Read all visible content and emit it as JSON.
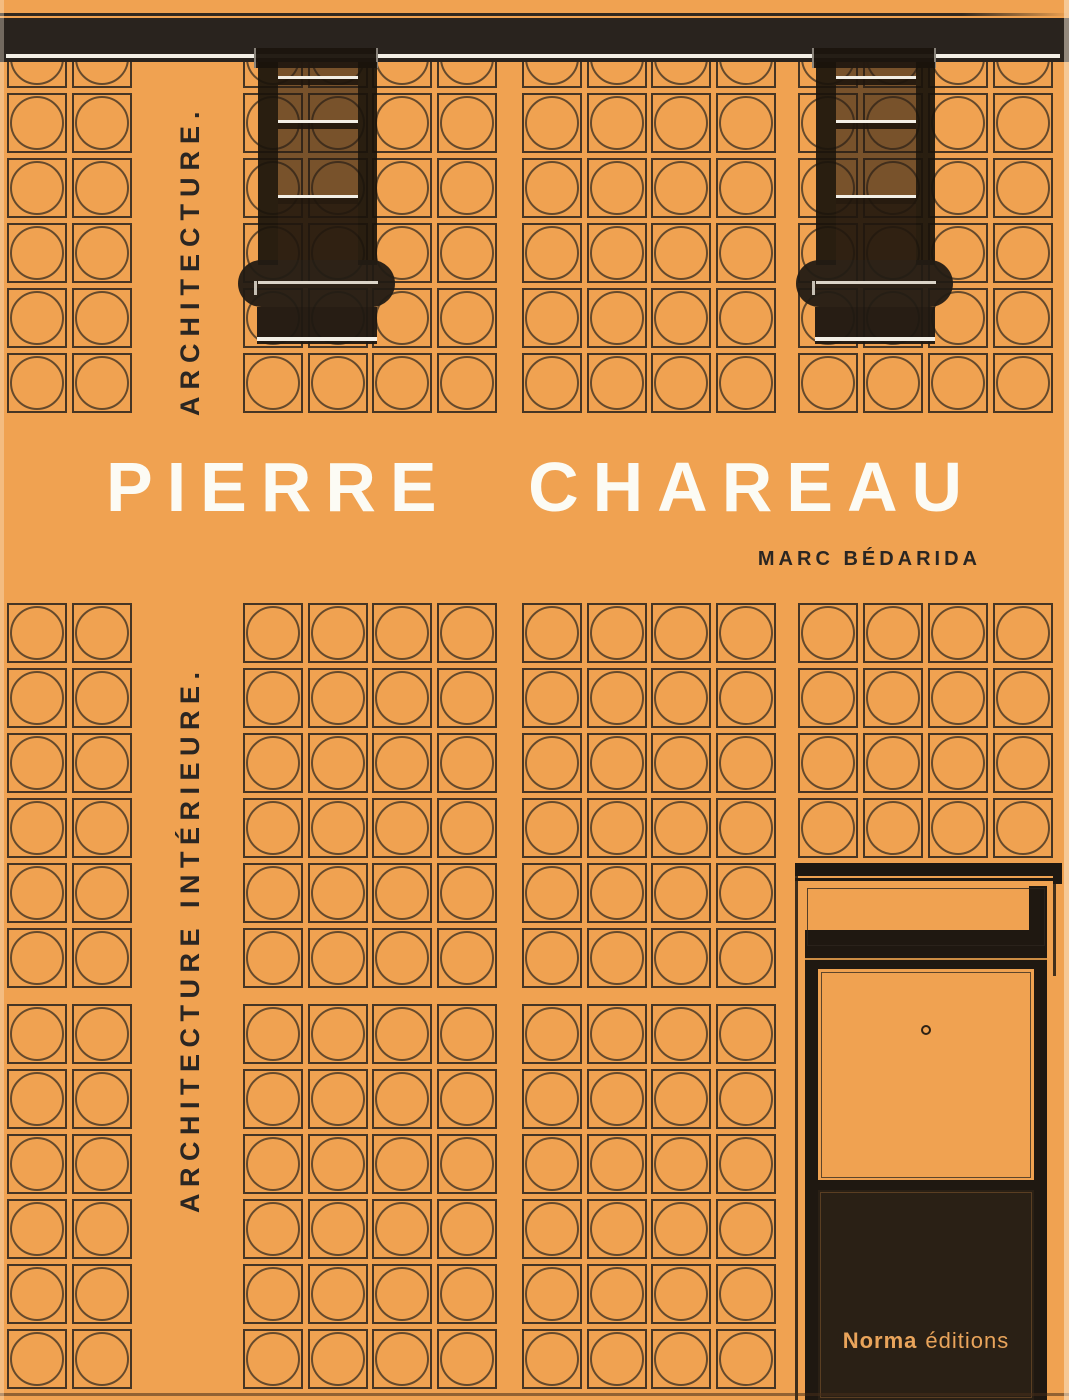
{
  "cover": {
    "vertical_label_top": "ARCHITECTURE.",
    "vertical_label_bottom": "ARCHITECTURE INTÉRIEURE.",
    "title": "PIERRE CHAREAU",
    "author": "MARC BÉDARIDA",
    "publisher": {
      "name": "Norma",
      "suffix": "éditions"
    }
  },
  "colors": {
    "background": "#F0A251",
    "ink_dark": "#2B2622",
    "band_black": "#29231E",
    "structure_black": "#1F1811",
    "door_panel_dark": "#2A2015",
    "title_white": "#FCFBF4",
    "publisher_text": "#E9A45B",
    "highlight_white": "#F3EFE6"
  },
  "facade_pattern": {
    "tile_size": 60,
    "column_groups": [
      [
        7,
        72
      ],
      [
        243,
        308,
        372,
        437
      ],
      [
        522,
        587,
        651,
        716
      ],
      [
        798,
        863,
        928,
        993
      ]
    ],
    "row_banks": [
      {
        "name": "top",
        "rows": [
          28,
          93,
          158,
          223,
          288,
          353
        ]
      },
      {
        "name": "middle",
        "rows": [
          603,
          668,
          733,
          798,
          863,
          928
        ],
        "group_row_limit": {
          "3": 4
        }
      },
      {
        "name": "bottom",
        "rows": [
          1004,
          1069,
          1134,
          1199,
          1264,
          1329
        ],
        "skip_groups": [
          3
        ]
      }
    ]
  }
}
